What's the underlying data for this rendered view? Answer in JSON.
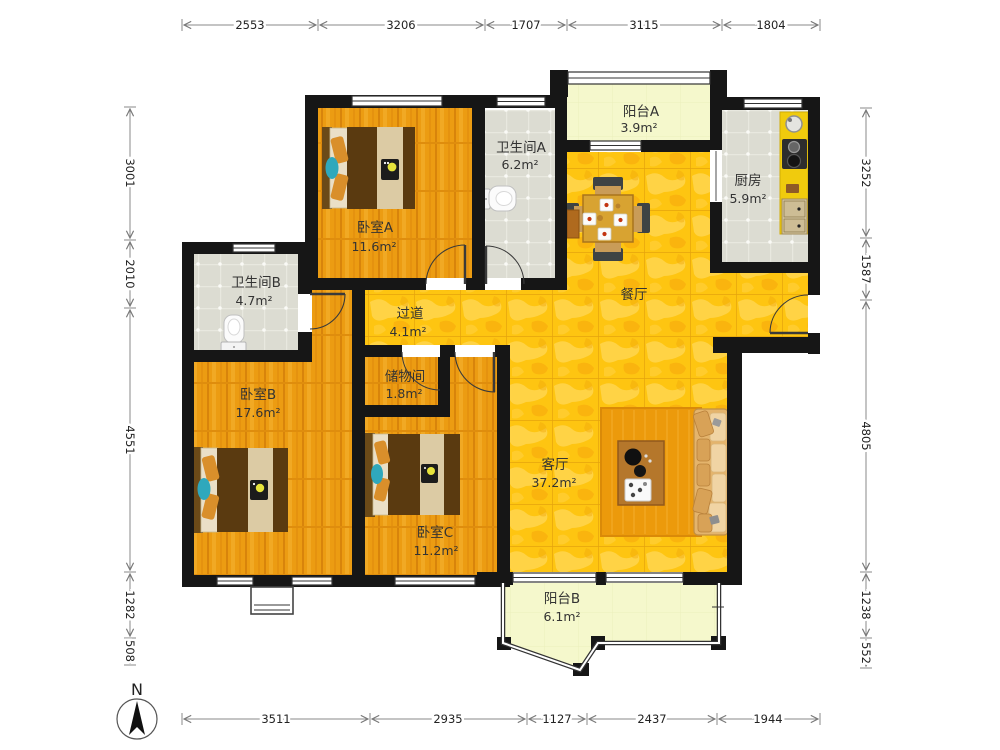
{
  "compass": {
    "label": "N"
  },
  "rooms": [
    {
      "id": "balcony-a",
      "name": "阳台A",
      "area": "3.9m²"
    },
    {
      "id": "bath-a",
      "name": "卫生间A",
      "area": "6.2m²"
    },
    {
      "id": "bedroom-a",
      "name": "卧室A",
      "area": "11.6m²"
    },
    {
      "id": "kitchen",
      "name": "厨房",
      "area": "5.9m²"
    },
    {
      "id": "dining",
      "name": "餐厅",
      "area": ""
    },
    {
      "id": "bath-b",
      "name": "卫生间B",
      "area": "4.7m²"
    },
    {
      "id": "hallway",
      "name": "过道",
      "area": "4.1m²"
    },
    {
      "id": "storage",
      "name": "储物间",
      "area": "1.8m²"
    },
    {
      "id": "bedroom-b",
      "name": "卧室B",
      "area": "17.6m²"
    },
    {
      "id": "bedroom-c",
      "name": "卧室C",
      "area": "11.2m²"
    },
    {
      "id": "living",
      "name": "客厅",
      "area": "37.2m²"
    },
    {
      "id": "balcony-b",
      "name": "阳台B",
      "area": "6.1m²"
    }
  ],
  "dims": {
    "top": [
      "2553",
      "3206",
      "1707",
      "3115",
      "1804"
    ],
    "bottom": [
      "3511",
      "2935",
      "1127",
      "2437",
      "1944"
    ],
    "left": [
      "3001",
      "2010",
      "4551",
      "1282",
      "508"
    ],
    "right": [
      "3252",
      "1587",
      "4805",
      "1238",
      "552"
    ]
  },
  "colors": {
    "wood_floor": "#EC9C12",
    "gold_tile": "#FEC511",
    "gray_tile": "#DCDCD2",
    "balcony": "#F5F8CC",
    "wall": "#161616"
  }
}
